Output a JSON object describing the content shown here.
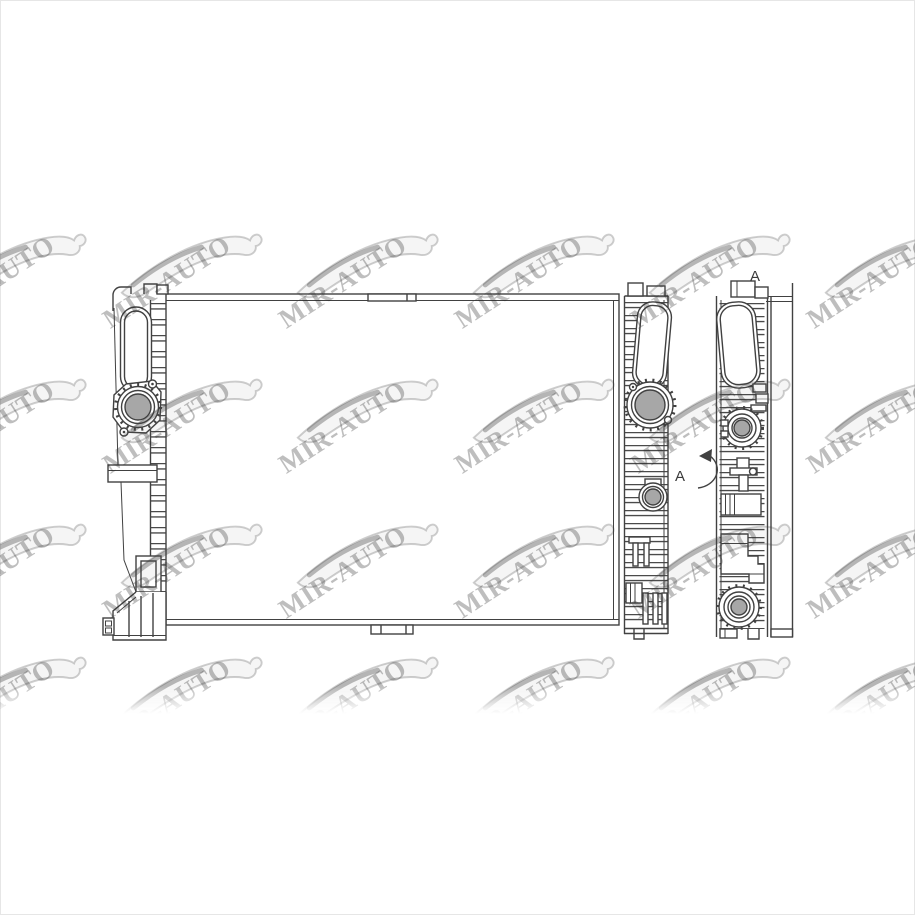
{
  "page": {
    "background": "#ffffff",
    "border_color": "#e6e6e6"
  },
  "drawing": {
    "alt": "radiator technical line drawing, front view with two side profile views",
    "line_color": "#414141",
    "metal_gray": "#a7a7a7",
    "labels": {
      "view_label": "A",
      "rotation_label": "A"
    }
  },
  "watermark": {
    "text": "MIR-AUTO",
    "text_color": "rgba(40,40,40,0.30)",
    "car_stroke": "rgba(60,60,60,0.25)",
    "car_fill": "rgba(120,120,120,0.07)",
    "car_accent": "rgba(60,60,60,0.35)",
    "angle_deg": -33,
    "grid": {
      "cols_x": [
        -70,
        106,
        282,
        458,
        634,
        810
      ],
      "rows_y": [
        222,
        367,
        512,
        645
      ],
      "unit_w": 176,
      "unit_h": 150
    }
  }
}
